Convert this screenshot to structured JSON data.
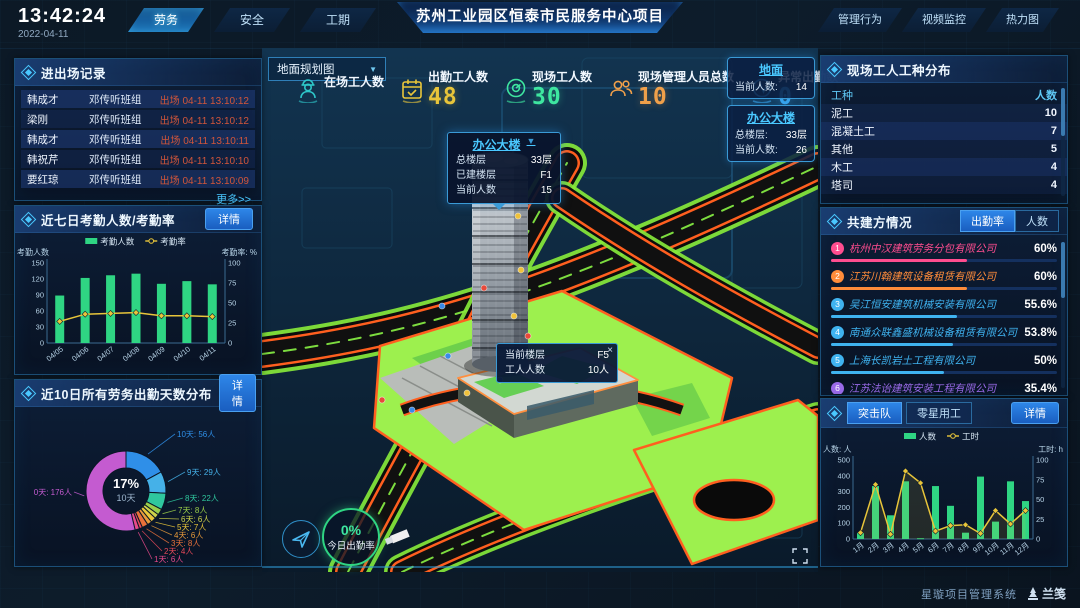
{
  "header": {
    "time": "13:42:24",
    "date": "2022-04-11",
    "title": "苏州工业园区恒泰市民服务中心项目",
    "left_tabs": [
      {
        "label": "劳务",
        "active": true
      },
      {
        "label": "安全",
        "active": false
      },
      {
        "label": "工期",
        "active": false
      }
    ],
    "right_tabs": [
      {
        "label": "管理行为",
        "active": false
      },
      {
        "label": "视频监控",
        "active": false
      },
      {
        "label": "热力图",
        "active": false
      }
    ]
  },
  "entry_exit_panel": {
    "title": "进出场记录",
    "more_label": "更多>>",
    "records": [
      {
        "name": "韩成才",
        "group": "邓传听班组",
        "event": "出场 04-11 13:10:12"
      },
      {
        "name": "梁刚",
        "group": "邓传听班组",
        "event": "出场 04-11 13:10:12"
      },
      {
        "name": "韩成才",
        "group": "邓传听班组",
        "event": "出场 04-11 13:10:11"
      },
      {
        "name": "韩祝芹",
        "group": "邓传听班组",
        "event": "出场 04-11 13:10:10"
      },
      {
        "name": "要红琼",
        "group": "邓传听班组",
        "event": "出场 04-11 13:10:09"
      }
    ]
  },
  "attendance_panel": {
    "title": "近七日考勤人数/考勤率",
    "detail_label": "详情"
  },
  "distribution_panel": {
    "title": "近10日所有劳务出勤天数分布",
    "detail_label": "详情"
  },
  "scene": {
    "view_select": {
      "value": "地面规划图"
    },
    "stats": [
      {
        "label": "在场工人数",
        "value": "",
        "icon": "worker-icon",
        "color": "#2ec7c9"
      },
      {
        "label": "出勤工人数",
        "value": "48",
        "icon": "calendar-check-icon",
        "color": "#e8c53a"
      },
      {
        "label": "现场工人数",
        "value": "30",
        "icon": "gauge-icon",
        "color": "#3ee6a0"
      },
      {
        "label": "现场管理人员总数",
        "value": "10",
        "icon": "people-icon",
        "color": "#f0a04a"
      },
      {
        "label": "异常出勤数",
        "value": "0",
        "icon": "pulse-icon",
        "color": "#3aa8f0"
      }
    ],
    "building_popup": {
      "title": "办公大楼",
      "caret": "▼",
      "rows": [
        {
          "label": "总楼层",
          "value": "33层"
        },
        {
          "label": "已建楼层",
          "value": "F1"
        },
        {
          "label": "当前人数",
          "value": "15"
        }
      ]
    },
    "floor_cards": [
      {
        "title": "地面",
        "rows": [
          {
            "label": "当前人数:",
            "value": "14"
          }
        ]
      },
      {
        "title": "办公大楼",
        "rows": [
          {
            "label": "总楼层:",
            "value": "33层"
          },
          {
            "label": "当前人数:",
            "value": "26"
          }
        ]
      }
    ],
    "floor_tooltip": {
      "close_label": "×",
      "rows": [
        {
          "label": "当前楼层",
          "value": "F5"
        },
        {
          "label": "工人人数",
          "value": "10人"
        }
      ]
    },
    "today_rate": {
      "value": "0%",
      "label": "今日出勤率"
    }
  },
  "worker_types_panel": {
    "title": "现场工人工种分布",
    "columns": [
      "工种",
      "人数"
    ],
    "rows": [
      {
        "type": "泥工",
        "count": "10"
      },
      {
        "type": "混凝土工",
        "count": "7"
      },
      {
        "type": "其他",
        "count": "5"
      },
      {
        "type": "木工",
        "count": "4"
      },
      {
        "type": "塔司",
        "count": "4"
      }
    ]
  },
  "partners_panel": {
    "title": "共建方情况",
    "tabs": [
      {
        "label": "出勤率",
        "active": true
      },
      {
        "label": "人数",
        "active": false
      }
    ],
    "items": [
      {
        "rank": "1",
        "name": "杭州中汉建筑劳务分包有限公司",
        "value": "60%",
        "pct": 60,
        "color": "#ff4d8f"
      },
      {
        "rank": "2",
        "name": "江苏川翰建筑设备租赁有限公司",
        "value": "60%",
        "pct": 60,
        "color": "#ff8c3a"
      },
      {
        "rank": "3",
        "name": "吴江恒安建筑机械安装有限公司",
        "value": "55.6%",
        "pct": 55.6,
        "color": "#3fb3f0"
      },
      {
        "rank": "4",
        "name": "南通众联鑫盛机械设备租赁有限公司",
        "value": "53.8%",
        "pct": 53.8,
        "color": "#3fb3f0"
      },
      {
        "rank": "5",
        "name": "上海长凯岩土工程有限公司",
        "value": "50%",
        "pct": 50,
        "color": "#3fb3f0"
      },
      {
        "rank": "6",
        "name": "江苏法诒建筑安装工程有限公司",
        "value": "35.4%",
        "pct": 35.4,
        "color": "#9a6ae8"
      }
    ]
  },
  "assault_panel": {
    "tabs": [
      {
        "label": "突击队",
        "active": true
      },
      {
        "label": "零星用工",
        "active": false
      }
    ],
    "detail_label": "详情"
  },
  "footer": {
    "system_name": "星璇项目管理系统",
    "logo_label": "兰笺"
  },
  "chart_data": [
    {
      "id": "attendance7",
      "type": "bar",
      "title": "近七日考勤人数/考勤率",
      "categories": [
        "04/05",
        "04/06",
        "04/07",
        "04/08",
        "04/09",
        "04/10",
        "04/11"
      ],
      "series": [
        {
          "name": "考勤人数",
          "kind": "bar",
          "axis": "left",
          "color": "#2fd583",
          "values": [
            89,
            122,
            127,
            130,
            111,
            116,
            110
          ]
        },
        {
          "name": "考勤率",
          "kind": "line",
          "axis": "right",
          "color": "#e8c53a",
          "values": [
            27,
            36,
            37,
            38,
            34,
            34,
            33
          ]
        }
      ],
      "left_axis": {
        "title": "考勤人数",
        "min": 0,
        "max": 150,
        "ticks": [
          0,
          30,
          60,
          90,
          120,
          150
        ]
      },
      "right_axis": {
        "title": "考勤率: %",
        "min": 0,
        "max": 100,
        "ticks": [
          0,
          25,
          50,
          75,
          100
        ]
      },
      "legend_position": "top",
      "grid": false
    },
    {
      "id": "days10",
      "type": "pie",
      "title": "近10日所有劳务出勤天数分布",
      "center_label": {
        "pct": "17%",
        "name": "10天"
      },
      "slices": [
        {
          "name": "10天",
          "value": 56,
          "label": "10天: 56人",
          "color": "#2f8fe8"
        },
        {
          "name": "9天",
          "value": 29,
          "label": "9天: 29人",
          "color": "#45b1e8"
        },
        {
          "name": "8天",
          "value": 22,
          "label": "8天: 22人",
          "color": "#2fc79e"
        },
        {
          "name": "7天",
          "value": 8,
          "label": "7天: 8人",
          "color": "#9acd4a"
        },
        {
          "name": "6天",
          "value": 6,
          "label": "6天: 6人",
          "color": "#cdd24a"
        },
        {
          "name": "5天",
          "value": 7,
          "label": "5天: 7人",
          "color": "#e8c53a"
        },
        {
          "name": "4天",
          "value": 6,
          "label": "4天: 6人",
          "color": "#e89a3a"
        },
        {
          "name": "3天",
          "value": 8,
          "label": "3天: 8人",
          "color": "#e8713a"
        },
        {
          "name": "2天",
          "value": 4,
          "label": "2天: 4人",
          "color": "#e84a5a"
        },
        {
          "name": "1天",
          "value": 6,
          "label": "1天: 6人",
          "color": "#e84a8a"
        },
        {
          "name": "0天",
          "value": 176,
          "label": "0天: 176人",
          "color": "#c45bd0"
        }
      ]
    },
    {
      "id": "assault",
      "type": "bar",
      "title": "突击队",
      "categories": [
        "1月",
        "2月",
        "3月",
        "4月",
        "5月",
        "6月",
        "7月",
        "8月",
        "9月",
        "10月",
        "11月",
        "12月"
      ],
      "series": [
        {
          "name": "人数",
          "kind": "bar",
          "axis": "left",
          "color": "#2fd583",
          "values": [
            40,
            335,
            150,
            365,
            5,
            335,
            210,
            40,
            395,
            110,
            365,
            240
          ]
        },
        {
          "name": "工时",
          "kind": "line",
          "axis": "right",
          "color": "#e8c53a",
          "values": [
            8,
            69,
            6,
            86,
            71,
            10,
            17,
            18,
            7,
            36,
            19,
            36
          ]
        }
      ],
      "left_axis": {
        "title": "人数: 人",
        "min": 0,
        "max": 500,
        "ticks": [
          0,
          100,
          200,
          300,
          400,
          500
        ]
      },
      "right_axis": {
        "title": "工时: h",
        "min": 0,
        "max": 100,
        "ticks": [
          0,
          25,
          50,
          75,
          100
        ]
      },
      "legend_position": "top",
      "grid": false
    }
  ]
}
